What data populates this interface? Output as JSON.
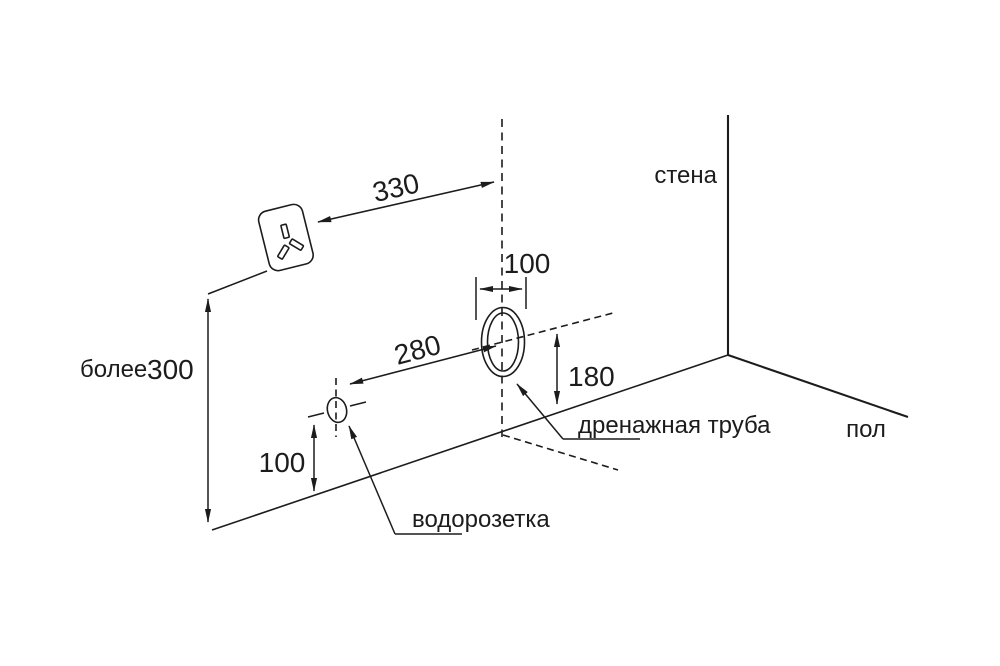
{
  "diagram": {
    "labels": {
      "wall": "стена",
      "floor": "пол",
      "drain_pipe": "дренажная труба",
      "water_socket": "водорозетка"
    },
    "dimensions": {
      "outlet_to_pipe_axis": "330",
      "pipe_hole_width": "100",
      "socket_to_pipe_center": "280",
      "pipe_center_to_floor": "180",
      "socket_to_floor": "100",
      "outlet_height_qualifier": "более",
      "outlet_height_value": "300"
    },
    "colors": {
      "line": "#1c1c1c",
      "background": "#ffffff"
    }
  }
}
